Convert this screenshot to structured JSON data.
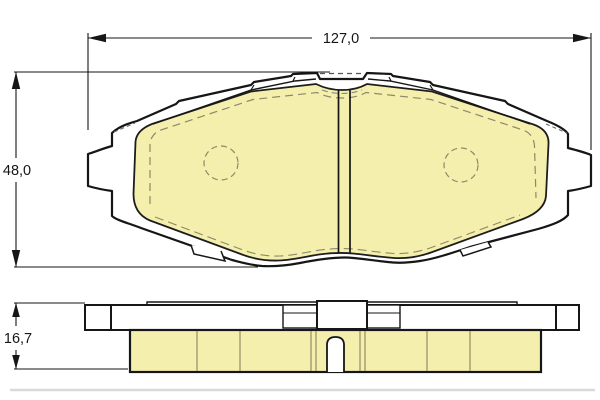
{
  "diagram": {
    "type": "brake-pad-technical-drawing",
    "dimensions": {
      "width_label": "127,0",
      "height_label": "48,0",
      "thickness_label": "16,7"
    },
    "colors": {
      "friction_material": "#F5EFAD",
      "outline": "#161616",
      "hidden_line": "#8a8a8a",
      "background": "#ffffff"
    },
    "views": {
      "front": "front-view-of-brake-pad",
      "side": "side-profile-view-of-brake-pad"
    }
  }
}
